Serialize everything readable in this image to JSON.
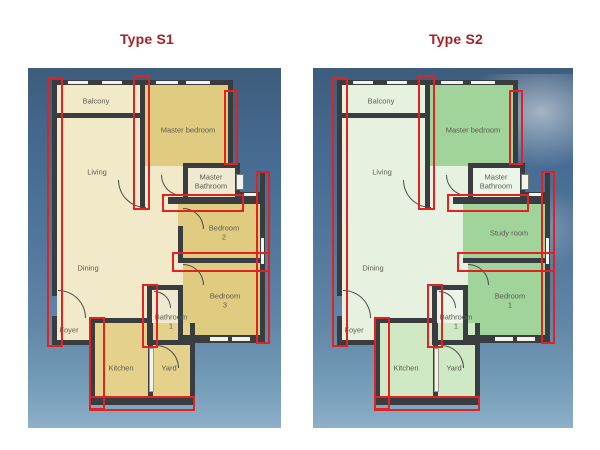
{
  "plans": {
    "s1": {
      "title": "Type S1",
      "rooms": {
        "balcony": "Balcony",
        "living": "Living",
        "master_bedroom": "Master bedroom",
        "master_bathroom": "Master\nBathroom",
        "room_upper_right": "Bedroom\n2",
        "room_lower_right": "Bedroom\n3",
        "dining": "Dining",
        "foyer": "Foyer",
        "bathroom1": "Bathroom\n1",
        "kitchen": "Kitchen",
        "yard": "Yard"
      },
      "palette": {
        "light": "#f2e9c8",
        "mid": "#e0cc80",
        "kitchen": "#e3d18c",
        "bathroom": "#f0e9d2"
      }
    },
    "s2": {
      "title": "Type S2",
      "rooms": {
        "balcony": "Balcony",
        "living": "Living",
        "master_bedroom": "Master bedroom",
        "master_bathroom": "Master\nBathroom",
        "room_upper_right": "Study room",
        "room_lower_right": "Bedroom\n1",
        "dining": "Dining",
        "foyer": "Foyer",
        "bathroom1": "Bathroom\n1",
        "kitchen": "Kitchen",
        "yard": "Yard"
      },
      "palette": {
        "light": "#e6f2df",
        "mid": "#a0d49a",
        "kitchen": "#cfe9c4",
        "bathroom": "#ecf6e8"
      }
    }
  },
  "colors": {
    "title_red": "#a62125",
    "highlight_red": "#e02222",
    "wall": "#393d3f",
    "sky_top": "#3e5d7d",
    "sky_bottom": "#8fb0c8",
    "label_text": "#5c5c4e"
  }
}
